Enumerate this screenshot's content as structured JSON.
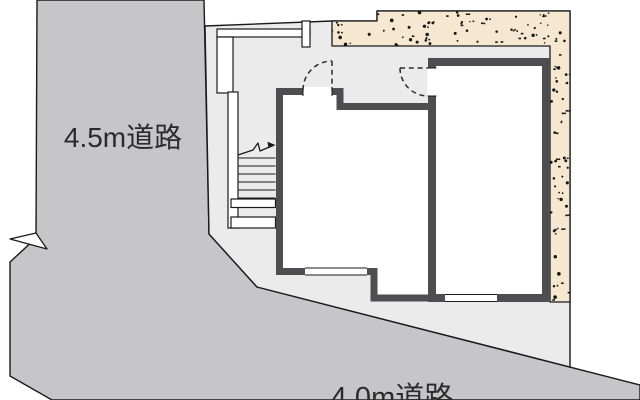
{
  "labels": {
    "road_left": "4.5m道路",
    "road_bottom": "4.0m道路"
  },
  "colors": {
    "background": "#ffffff",
    "road": "#c6c6c8",
    "site": "#ebebec",
    "open_space": "#f6e7d1",
    "wall_dark": "#4e4e50",
    "wall_white": "#ffffff",
    "room_floor": "#ffffff",
    "line": "#1a1a1a",
    "text": "#2b2b2b",
    "stipple_dot": "#161616"
  },
  "texture": {
    "name": "stipple-dots",
    "dot_count_top": 70,
    "dot_count_right": 48,
    "seed": 42
  },
  "stairs": {
    "tread_lines": 6,
    "first_tread_y": 158,
    "tread_step": 8,
    "x1": 238,
    "x2": 275.5
  }
}
